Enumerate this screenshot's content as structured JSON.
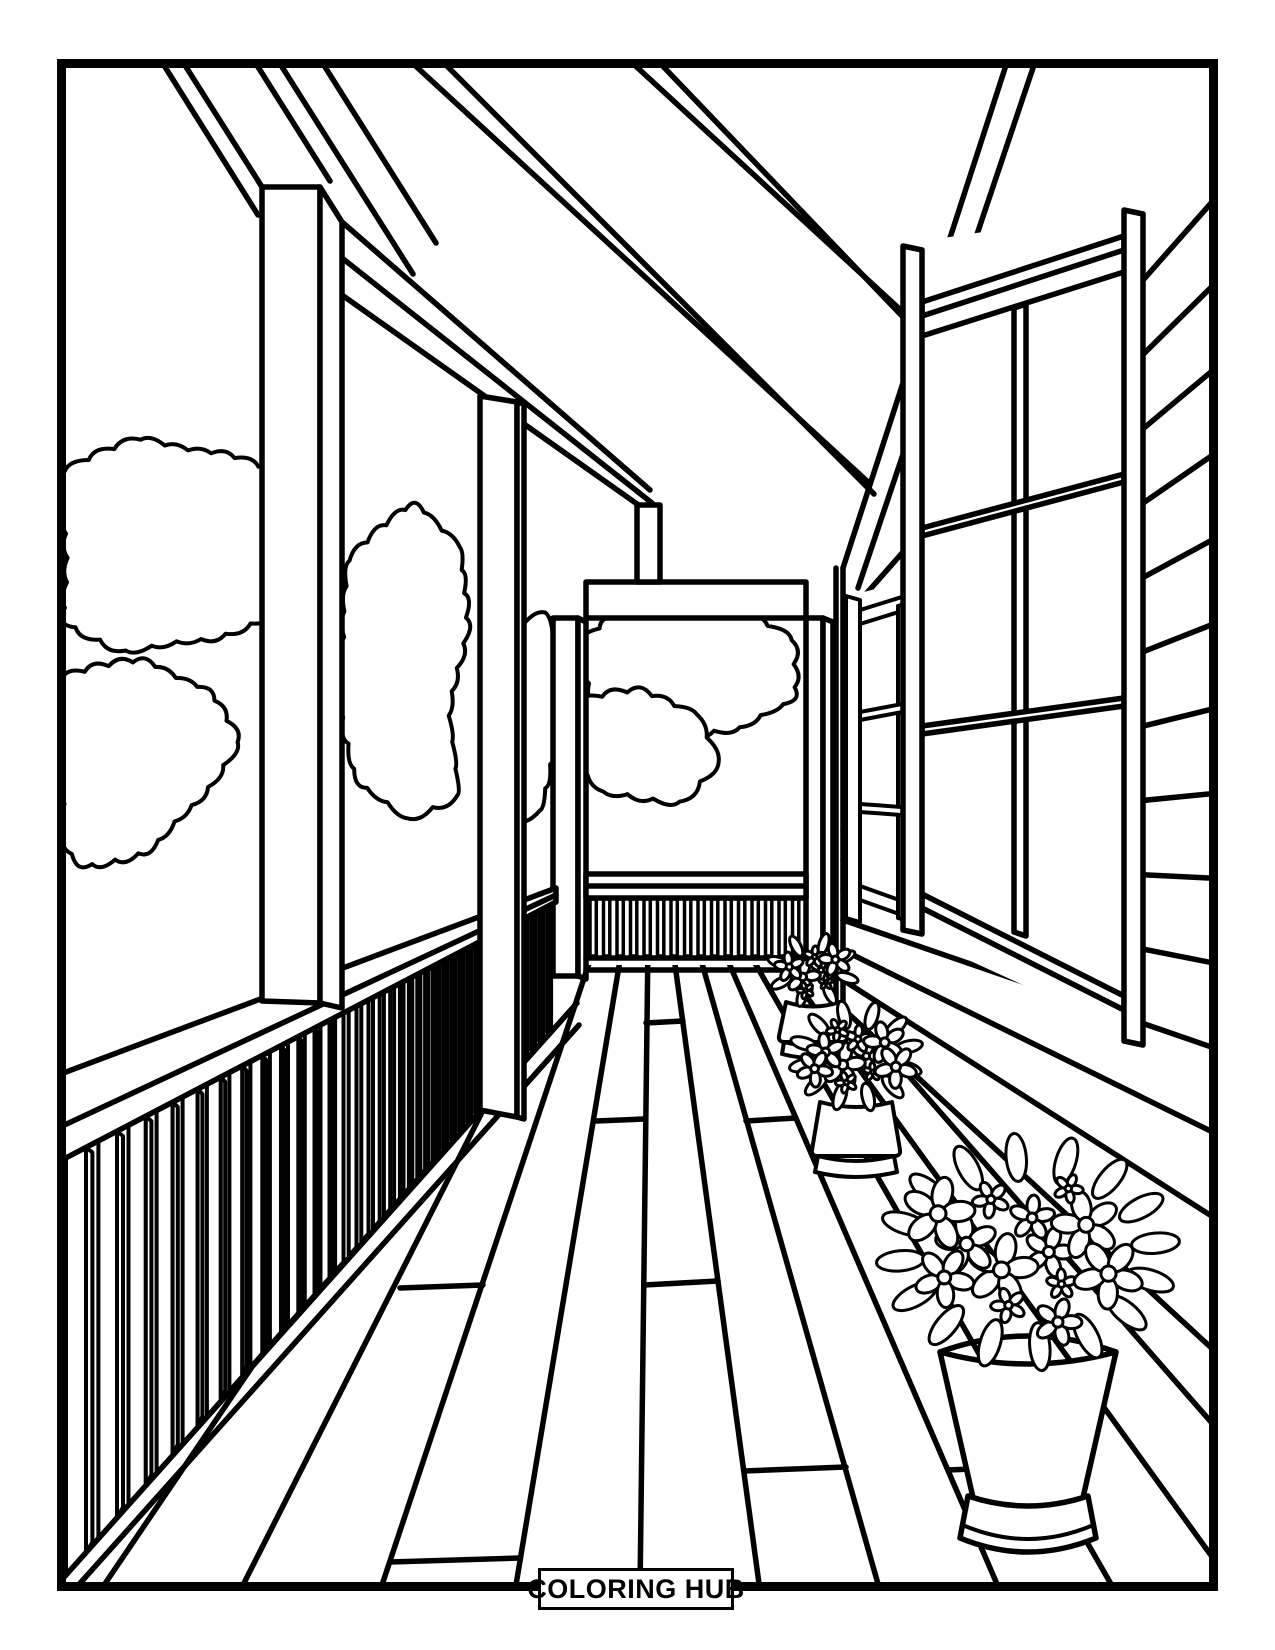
{
  "colors": {
    "ink": "#000000",
    "paper": "#ffffff"
  },
  "footer": {
    "brand": "COLORING HUB"
  },
  "illustration": {
    "alt": "Black and white coloring page: a covered front porch in one-point perspective with roof beams, square posts, railings with balusters, a house wall of horizontal siding with two paned windows, garden bushes beyond the rails, wooden deck boards, and three potted flower arrangements"
  }
}
